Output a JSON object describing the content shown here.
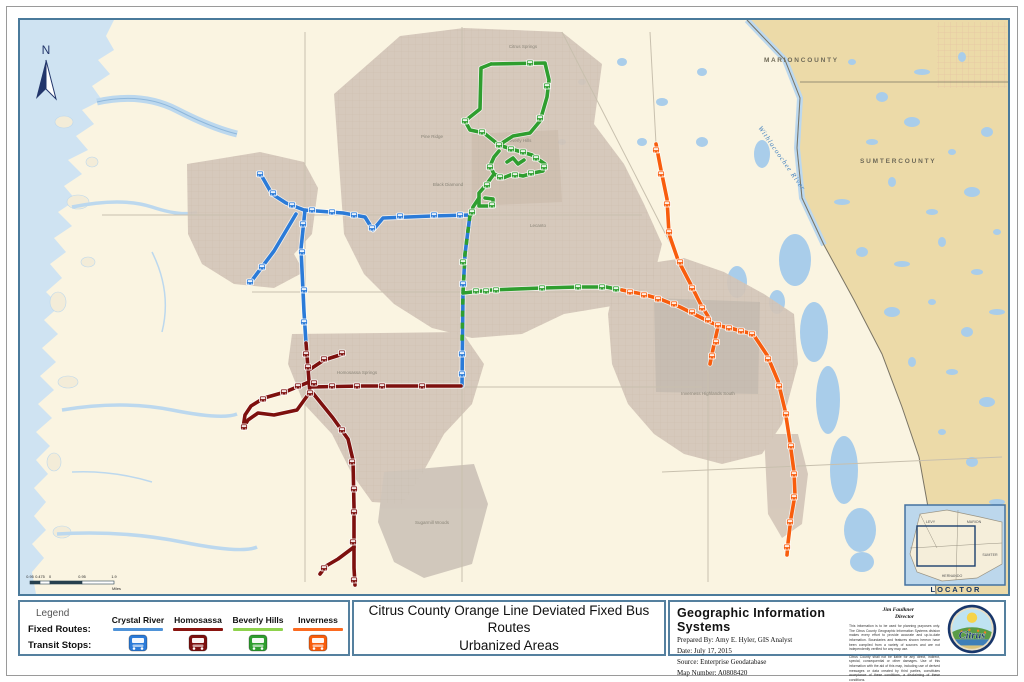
{
  "page": {
    "title_line1": "Citrus County Orange Line Deviated Fixed Bus Routes",
    "title_line2": "Urbanized Areas"
  },
  "legend": {
    "heading": "Legend",
    "row_fixed_routes": "Fixed Routes:",
    "row_transit_stops": "Transit Stops:",
    "columns": [
      {
        "name": "Crystal River",
        "line_color": "#4f93d8",
        "stop_color": "#2b7bd8"
      },
      {
        "name": "Homosassa",
        "line_color": "#8a1510",
        "stop_color": "#7d100e"
      },
      {
        "name": "Beverly Hills",
        "line_color": "#8ed24d",
        "stop_color": "#2f9e2f"
      },
      {
        "name": "Inverness",
        "line_color": "#fb6a20",
        "stop_color": "#f85d0d"
      }
    ]
  },
  "gis": {
    "heading": "Geographic Information Systems",
    "prepared_by": "Prepared By:  Amy E. Hyler, GIS Analyst",
    "date": "Date:  July 17, 2015",
    "source": "Source:  Enterprise Geodatabase",
    "map_number": "Map Number:  A0808420",
    "director_name": "Jim Faulkner",
    "director_title": "Director",
    "seal_text": "Citrus",
    "disclaimer1": "This information is to be used for planning purposes only. The Citrus County Geographic Information Systems division makes every effort to provide accurate and up-to-date information. Boundaries and features shown hereon have been compiled from a variety of sources and are not independently verified for any map use.",
    "disclaimer2": "Citrus County shall not be liable for any direct, indirect, special, consequential or other damages. Use of this information with the aid of this map, including use of derived messages or data created by third parties, constitutes acceptance of these conditions, a disclaiming of these conditions."
  },
  "map": {
    "north_label": "N",
    "labels": {
      "marion": "M A R I O N   C O U N T Y",
      "sumter": "S U M T E R   C O U N T Y",
      "river": "Withlacoochee River"
    },
    "town_labels": [
      {
        "text": "Citrus Springs",
        "x": 521,
        "y": 46
      },
      {
        "text": "Pine Ridge",
        "x": 430,
        "y": 136
      },
      {
        "text": "Black Diamond",
        "x": 446,
        "y": 184
      },
      {
        "text": "Beverly Hills",
        "x": 517,
        "y": 140
      },
      {
        "text": "Lecanto",
        "x": 536,
        "y": 225
      },
      {
        "text": "Homosassa Springs",
        "x": 355,
        "y": 372
      },
      {
        "text": "Sugarmill Woods",
        "x": 430,
        "y": 522
      },
      {
        "text": "Inverness Highlands South",
        "x": 706,
        "y": 393
      }
    ],
    "scalebar": {
      "labels": [
        "0.95",
        "0.475",
        "0",
        "0.95",
        "1.9"
      ],
      "unit": "Miles"
    },
    "locator": {
      "title": "L O C A T O R",
      "counties": [
        "LEVY",
        "MARION",
        "SUMTER",
        "HERNANDO"
      ]
    },
    "routes": [
      {
        "name": "crystal-river",
        "color": "#2b7bd8",
        "paths": [
          "M258,171 L270,192 L284,201 L302,208 L341,211 L363,215 L371,228 L381,216 L430,214 L468,213",
          "M303,208 L299,247 L302,310 L304,341",
          "M294,212 L272,249 L248,281",
          "M468,213 L463,252 L461,291 L460,384"
        ],
        "stops": [
          [
            258,
            172
          ],
          [
            271,
            191
          ],
          [
            290,
            203
          ],
          [
            310,
            208
          ],
          [
            330,
            210
          ],
          [
            352,
            213
          ],
          [
            370,
            226
          ],
          [
            398,
            214
          ],
          [
            432,
            213
          ],
          [
            458,
            213
          ],
          [
            301,
            222
          ],
          [
            300,
            250
          ],
          [
            302,
            288
          ],
          [
            302,
            320
          ],
          [
            260,
            265
          ],
          [
            248,
            280
          ],
          [
            461,
            282
          ],
          [
            460,
            352
          ],
          [
            460,
            372
          ]
        ]
      },
      {
        "name": "homosassa",
        "color": "#7d100e",
        "paths": [
          "M304,341 L306,366 L308,392",
          "M307,368 L322,358 L341,352",
          "M308,385 L360,384 L459,384",
          "M307,380 L283,390 L262,396 L249,404 L243,413 L241,426",
          "M308,390 L295,408 L272,413 L256,411 L246,418 L241,426",
          "M310,390 L331,416 L346,437 L351,458 L352,505 L352,566 L353,583",
          "M352,545 L336,557 L324,564 L318,572"
        ],
        "stops": [
          [
            304,
            352
          ],
          [
            306,
            365
          ],
          [
            322,
            357
          ],
          [
            340,
            351
          ],
          [
            296,
            384
          ],
          [
            312,
            381
          ],
          [
            308,
            391
          ],
          [
            282,
            390
          ],
          [
            261,
            397
          ],
          [
            242,
            425
          ],
          [
            330,
            384
          ],
          [
            355,
            384
          ],
          [
            380,
            384
          ],
          [
            420,
            384
          ],
          [
            340,
            428
          ],
          [
            350,
            460
          ],
          [
            352,
            487
          ],
          [
            352,
            510
          ],
          [
            351,
            540
          ],
          [
            322,
            566
          ],
          [
            352,
            578
          ]
        ]
      },
      {
        "name": "beverly-hills",
        "color": "#2f9e2f",
        "paths": [
          "M489,62 L543,61 L547,78 L545,95 L538,119 L528,131 L511,134 L497,143",
          "M489,62 L479,66 L478,107 L463,119 L468,128 L482,131 L497,143",
          "M497,143 L509,147 L520,150 L530,153 L537,158 L543,162 L541,169 L531,171 L521,174 L511,172 L501,176 L492,172 L488,164 L492,155 L497,149",
          "M505,160 L511,156 L516,162 L522,158",
          "M492,172 L484,183 L477,191 L477,204 L491,204 L491,197 L483,196",
          "M477,196 L471,205 L469,213",
          "M461,291 L489,288 L540,286 L576,285 L604,285 L620,288"
        ],
        "dash_paths": [
          "M468,213 L463,252 L461,291 L460,340"
        ],
        "stops": [
          [
            528,
            61
          ],
          [
            545,
            84
          ],
          [
            538,
            116
          ],
          [
            463,
            119
          ],
          [
            480,
            130
          ],
          [
            497,
            143
          ],
          [
            509,
            147
          ],
          [
            521,
            150
          ],
          [
            534,
            156
          ],
          [
            542,
            165
          ],
          [
            529,
            171
          ],
          [
            513,
            173
          ],
          [
            498,
            175
          ],
          [
            488,
            165
          ],
          [
            485,
            183
          ],
          [
            490,
            203
          ],
          [
            470,
            210
          ],
          [
            461,
            260
          ],
          [
            474,
            289
          ],
          [
            484,
            289
          ],
          [
            494,
            288
          ],
          [
            540,
            286
          ],
          [
            576,
            285
          ],
          [
            600,
            285
          ],
          [
            614,
            287
          ]
        ]
      },
      {
        "name": "inverness",
        "color": "#f85d0d",
        "paths": [
          "M654,142 L659,168 L665,197 L667,232 L676,258 L688,281 L698,301 L707,316",
          "M620,288 L640,292 L658,297 L678,305 L700,316",
          "M700,316 L710,321 L718,324 L728,326 L739,329 L751,332",
          "M716,325 L713,338 L710,352 L708,362",
          "M751,332 L765,353 L776,379 L783,408 L788,440 L792,470 L793,493 L789,516 L786,541 L785,553"
        ],
        "stops": [
          [
            654,
            148
          ],
          [
            659,
            172
          ],
          [
            665,
            202
          ],
          [
            667,
            230
          ],
          [
            678,
            260
          ],
          [
            690,
            286
          ],
          [
            700,
            306
          ],
          [
            628,
            290
          ],
          [
            642,
            293
          ],
          [
            656,
            297
          ],
          [
            672,
            302
          ],
          [
            690,
            310
          ],
          [
            706,
            318
          ],
          [
            716,
            323
          ],
          [
            727,
            326
          ],
          [
            739,
            329
          ],
          [
            750,
            332
          ],
          [
            714,
            340
          ],
          [
            710,
            354
          ],
          [
            766,
            357
          ],
          [
            777,
            384
          ],
          [
            784,
            412
          ],
          [
            789,
            444
          ],
          [
            792,
            472
          ],
          [
            792,
            495
          ],
          [
            788,
            520
          ],
          [
            785,
            545
          ]
        ]
      }
    ]
  }
}
